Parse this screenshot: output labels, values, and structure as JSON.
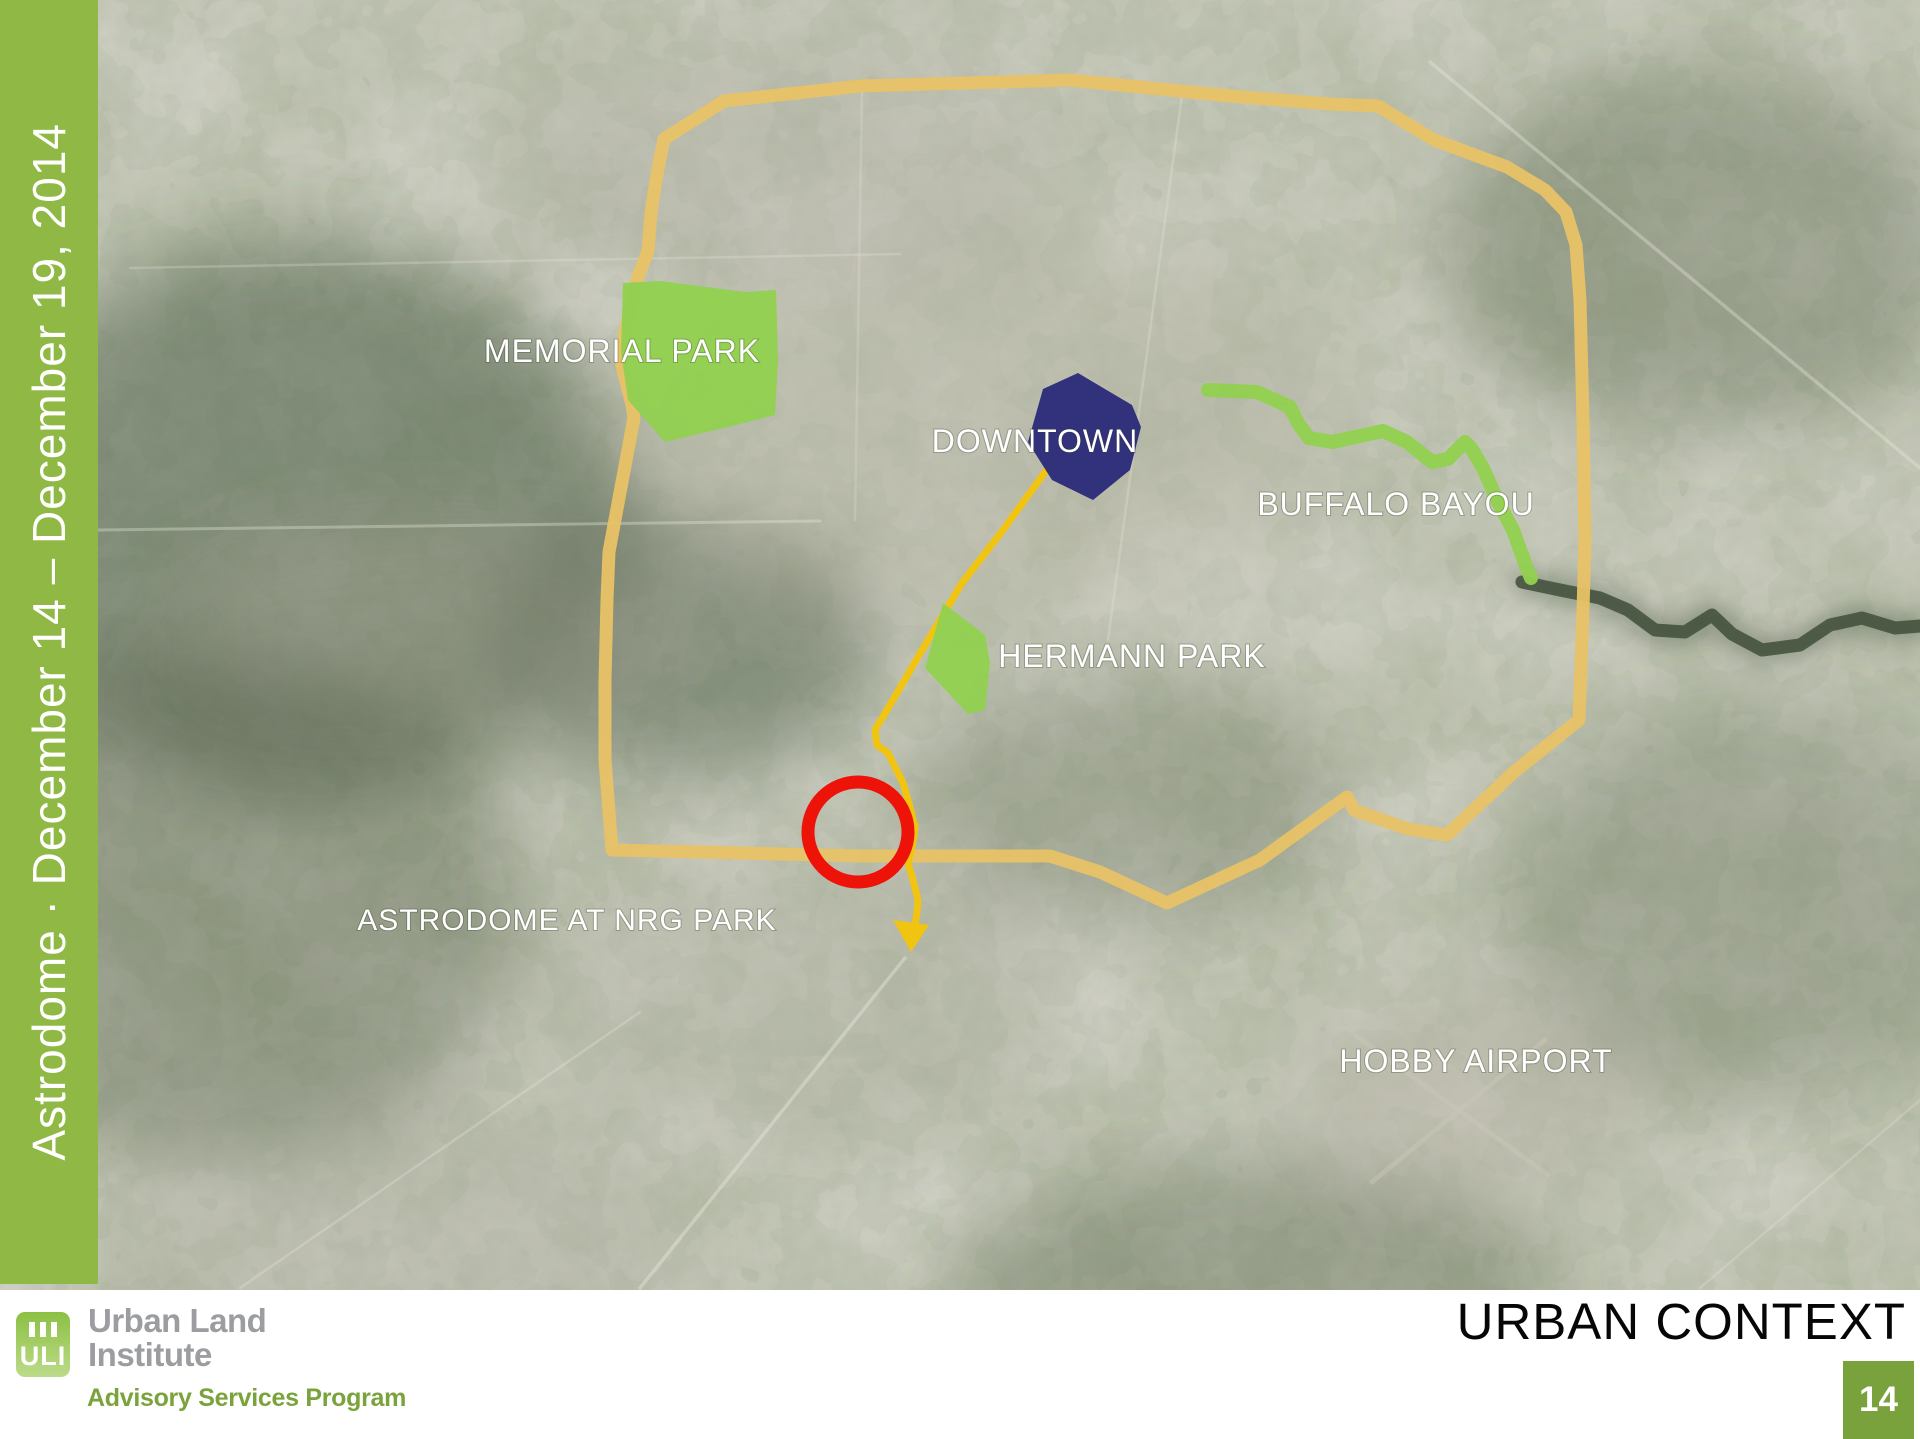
{
  "sidebar": {
    "title": "Astrodome · December 14 – December 19, 2014"
  },
  "map": {
    "labels": [
      {
        "id": "memorial-park",
        "text": "MEMORIAL PARK"
      },
      {
        "id": "downtown",
        "text": "DOWNTOWN"
      },
      {
        "id": "buffalo-bayou",
        "text": "BUFFALO BAYOU"
      },
      {
        "id": "hermann-park",
        "text": "HERMANN PARK"
      },
      {
        "id": "astrodome",
        "text": "ASTRODOME AT NRG PARK"
      },
      {
        "id": "hobby-airport",
        "text": "HOBBY AIRPORT"
      }
    ],
    "colors": {
      "loop_highway": "#e8c266",
      "route_line": "#f1c411",
      "park_green": "#92d050",
      "bayou_green": "#92d050",
      "downtown_navy": "#2d2c7a",
      "marker_red": "#ee1309"
    }
  },
  "footer": {
    "title": "URBAN CONTEXT",
    "page_number": "14",
    "logo": {
      "acronym": "ULI",
      "org_line1": "Urban Land",
      "org_line2": "Institute",
      "program": "Advisory Services Program"
    }
  },
  "brand": {
    "sidebar_green": "#8fb944",
    "page_box_green": "#7aa23c",
    "uli_logo_green": "#8cc043",
    "uli_text_gray": "#9b9da0",
    "uli_program_green": "#7aa33b"
  }
}
